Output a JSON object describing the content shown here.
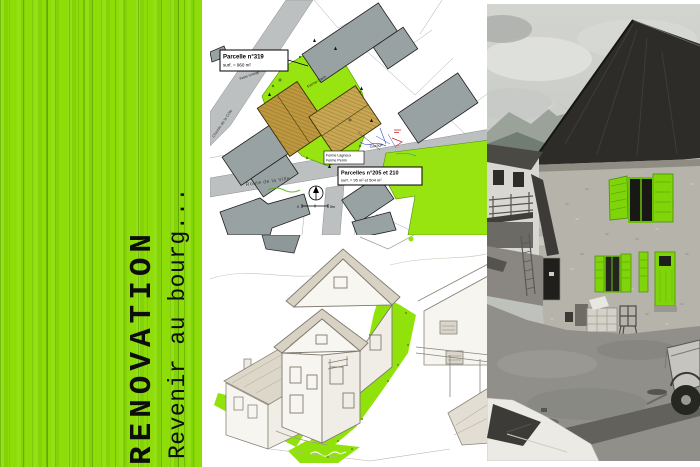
{
  "poster": {
    "panel": {
      "title": "RENOVATION",
      "subtitle": "Revenir au bourg...",
      "green": "#8edd08"
    },
    "site_plan": {
      "parcel_a": {
        "line1": "Parcelle n°319",
        "line2": "surf. = 960 m²"
      },
      "parcel_b": {
        "line1": "Parcelles n°205 et 210",
        "line2": "surf. = 95 m² et 504 m²"
      },
      "roads": {
        "main": "Route de la Ville",
        "side": "Chemin de la Côte"
      },
      "farms": {
        "top": "Ferme Garin",
        "bottom1": "Ferme Lagneux",
        "bottom2": "Ferme Perrin",
        "barn": "Petite Grange"
      },
      "garage": "Garage",
      "scale": {
        "zero": "0",
        "end": "5m"
      },
      "colors": {
        "parcel_green": "#97e411",
        "project_tan": "#c9a855",
        "existing_gray": "#99a2a3"
      }
    },
    "photo": {
      "accent_green": "#7fd40a"
    }
  }
}
